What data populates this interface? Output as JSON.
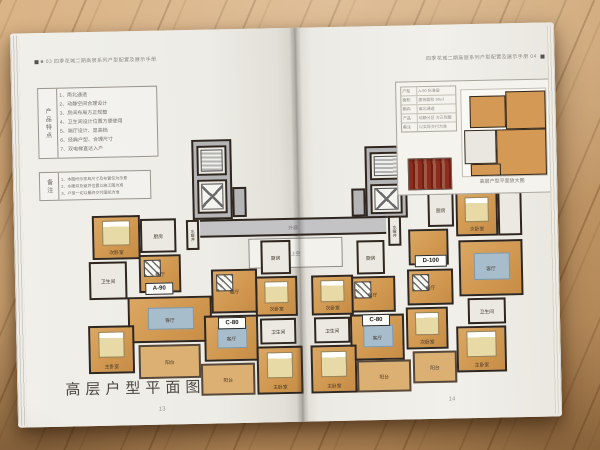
{
  "colors": {
    "wood": "#c49a6a",
    "page": "#efeee8",
    "room_orange": "#d49a55",
    "balcony": "#dcb072",
    "wet_floor": "#ebe9e2",
    "core_grey": "#b5b4b7",
    "wall": "#2f271f",
    "rug_blue": "#a8bdcb",
    "stamp_red": "#8d2b1e"
  },
  "left_page": {
    "header": "■ 03  四季花城二期高层系列户型配置及展示手册",
    "features_table": {
      "header": "产品特点",
      "items": [
        "1、南北通透",
        "2、动静空间合理设计",
        "3、房间布局方正规整",
        "4、卫生间设计位置方便使用",
        "5、端厅设计、显高档",
        "6、经典户型、合理尺寸",
        "7、双电梯直达入户"
      ]
    },
    "notes_table": {
      "header": "备注",
      "items": [
        "1、本图所示家具尺寸及布置仅为示意",
        "2、水暖井及管井位置以施工图为准",
        "3、户型一切以最终交付图纸为准"
      ]
    },
    "caption": "高层户型平面图",
    "page_number": "13"
  },
  "right_page": {
    "header": "四季花城二期高层系列户型配置及展示手册  04 ",
    "inset": {
      "rows": [
        [
          "户型",
          "A-90 标准层"
        ],
        [
          "面积",
          "建筑面积 90㎡"
        ],
        [
          "朝向",
          "南北通透"
        ],
        [
          "产品",
          "动静分区 方正规整"
        ],
        [
          "备注",
          "以实际交付为准"
        ]
      ],
      "caption": "高层户型平面放大图"
    },
    "page_number": "14"
  },
  "floor_plan": {
    "unit_tags": [
      "A-90",
      "C-80",
      "C-80",
      "D-100"
    ],
    "rooms": [
      {
        "name": "core-tower-left",
        "label": "",
        "x": 179,
        "y": 110,
        "w": 40,
        "h": 80,
        "kind": "grey"
      },
      {
        "name": "stair-left",
        "label": "",
        "x": 184,
        "y": 116,
        "w": 30,
        "h": 30,
        "kind": "wet",
        "furn": "stair"
      },
      {
        "name": "elevator-left",
        "label": "",
        "x": 184,
        "y": 150,
        "w": 30,
        "h": 34,
        "kind": "wet",
        "furn": "elev"
      },
      {
        "name": "shaft-left",
        "label": "",
        "x": 219,
        "y": 158,
        "w": 14,
        "h": 30,
        "kind": "grey"
      },
      {
        "name": "core-tower-right",
        "label": "",
        "x": 352,
        "y": 120,
        "w": 42,
        "h": 72,
        "kind": "grey"
      },
      {
        "name": "stair-right",
        "label": "",
        "x": 357,
        "y": 126,
        "w": 32,
        "h": 28,
        "kind": "wet",
        "furn": "stair"
      },
      {
        "name": "elevator-right",
        "label": "",
        "x": 357,
        "y": 158,
        "w": 32,
        "h": 30,
        "kind": "wet",
        "furn": "elev"
      },
      {
        "name": "shaft-right",
        "label": "",
        "x": 338,
        "y": 162,
        "w": 14,
        "h": 28,
        "kind": "grey"
      },
      {
        "name": "corridor",
        "label": "外廊",
        "x": 186,
        "y": 190,
        "w": 186,
        "h": 18,
        "kind": "corridor"
      },
      {
        "name": "void-above",
        "label": "上空",
        "x": 234,
        "y": 210,
        "w": 94,
        "h": 30,
        "kind": "void"
      },
      {
        "name": "pipe-shaft-left",
        "label": "水暖井",
        "x": 172,
        "y": 190,
        "w": 13,
        "h": 30,
        "kind": "wet",
        "vertical": true
      },
      {
        "name": "pipe-shaft-right",
        "label": "水暖井",
        "x": 374,
        "y": 190,
        "w": 13,
        "h": 30,
        "kind": "wet",
        "vertical": true
      },
      {
        "name": "a90-bedroom2",
        "label": "次卧室",
        "x": 78,
        "y": 184,
        "w": 48,
        "h": 44,
        "kind": "room",
        "furn": "bed"
      },
      {
        "name": "a90-bathroom",
        "label": "卫生间",
        "x": 74,
        "y": 230,
        "w": 38,
        "h": 38,
        "kind": "wet"
      },
      {
        "name": "a90-kitchen",
        "label": "厨房",
        "x": 126,
        "y": 188,
        "w": 36,
        "h": 34,
        "kind": "wet"
      },
      {
        "name": "a90-dining",
        "label": "餐厅",
        "x": 124,
        "y": 224,
        "w": 42,
        "h": 38,
        "kind": "room",
        "furn": "hatch"
      },
      {
        "name": "a90-living",
        "label": "客厅",
        "x": 112,
        "y": 266,
        "w": 84,
        "h": 46,
        "kind": "room",
        "furn": "rug"
      },
      {
        "name": "a90-master",
        "label": "主卧室",
        "x": 72,
        "y": 294,
        "w": 46,
        "h": 48,
        "kind": "room",
        "furn": "bed"
      },
      {
        "name": "a90-balcony",
        "label": "阳台",
        "x": 122,
        "y": 314,
        "w": 62,
        "h": 34,
        "kind": "balcony"
      },
      {
        "name": "a90-tag",
        "label": "A-90",
        "x": 130,
        "y": 252,
        "w": 28,
        "h": 12,
        "kind": "tag"
      },
      {
        "name": "c80l-kitchen",
        "label": "厨房",
        "x": 246,
        "y": 212,
        "w": 30,
        "h": 34,
        "kind": "wet"
      },
      {
        "name": "c80l-dining",
        "label": "餐厅",
        "x": 196,
        "y": 240,
        "w": 46,
        "h": 44,
        "kind": "room",
        "furn": "hatch"
      },
      {
        "name": "c80l-bedroom2",
        "label": "次卧室",
        "x": 240,
        "y": 248,
        "w": 42,
        "h": 40,
        "kind": "room",
        "furn": "bed"
      },
      {
        "name": "c80l-bathroom",
        "label": "卫生间",
        "x": 244,
        "y": 290,
        "w": 36,
        "h": 26,
        "kind": "wet"
      },
      {
        "name": "c80l-living",
        "label": "客厅",
        "x": 188,
        "y": 286,
        "w": 54,
        "h": 46,
        "kind": "room",
        "furn": "rug"
      },
      {
        "name": "c80l-master",
        "label": "主卧室",
        "x": 240,
        "y": 318,
        "w": 46,
        "h": 48,
        "kind": "room",
        "furn": "bed"
      },
      {
        "name": "c80l-balcony",
        "label": "阳台",
        "x": 184,
        "y": 334,
        "w": 54,
        "h": 32,
        "kind": "balcony"
      },
      {
        "name": "c80l-tag",
        "label": "C-80",
        "x": 202,
        "y": 288,
        "w": 28,
        "h": 12,
        "kind": "tag"
      },
      {
        "name": "c80r-kitchen",
        "label": "厨房",
        "x": 342,
        "y": 214,
        "w": 28,
        "h": 34,
        "kind": "wet"
      },
      {
        "name": "c80r-dining",
        "label": "餐厅",
        "x": 334,
        "y": 250,
        "w": 46,
        "h": 36,
        "kind": "room",
        "furn": "hatch"
      },
      {
        "name": "c80r-bedroom2",
        "label": "次卧室",
        "x": 296,
        "y": 248,
        "w": 42,
        "h": 40,
        "kind": "room",
        "furn": "bed"
      },
      {
        "name": "c80r-bathroom",
        "label": "卫生间",
        "x": 298,
        "y": 290,
        "w": 36,
        "h": 26,
        "kind": "wet"
      },
      {
        "name": "c80r-living",
        "label": "客厅",
        "x": 334,
        "y": 288,
        "w": 54,
        "h": 46,
        "kind": "room",
        "furn": "rug"
      },
      {
        "name": "c80r-master",
        "label": "主卧室",
        "x": 294,
        "y": 318,
        "w": 46,
        "h": 48,
        "kind": "room",
        "furn": "bed"
      },
      {
        "name": "c80r-balcony",
        "label": "阳台",
        "x": 340,
        "y": 334,
        "w": 54,
        "h": 32,
        "kind": "balcony"
      },
      {
        "name": "c80r-tag",
        "label": "C-80",
        "x": 346,
        "y": 288,
        "w": 28,
        "h": 12,
        "kind": "tag"
      },
      {
        "name": "d100-hall",
        "label": "",
        "x": 394,
        "y": 204,
        "w": 40,
        "h": 36,
        "kind": "room"
      },
      {
        "name": "d100-kitchen",
        "label": "厨房",
        "x": 414,
        "y": 168,
        "w": 26,
        "h": 34,
        "kind": "wet"
      },
      {
        "name": "d100-bedroom2a",
        "label": "次卧室",
        "x": 442,
        "y": 168,
        "w": 42,
        "h": 44,
        "kind": "room",
        "furn": "bed"
      },
      {
        "name": "d100-utility",
        "label": "",
        "x": 484,
        "y": 168,
        "w": 24,
        "h": 44,
        "kind": "wet"
      },
      {
        "name": "d100-living",
        "label": "客厅",
        "x": 444,
        "y": 216,
        "w": 64,
        "h": 56,
        "kind": "room",
        "furn": "rug"
      },
      {
        "name": "d100-dining",
        "label": "餐厅",
        "x": 392,
        "y": 244,
        "w": 46,
        "h": 36,
        "kind": "room",
        "furn": "hatch"
      },
      {
        "name": "d100-bedroom2b",
        "label": "次卧室",
        "x": 390,
        "y": 282,
        "w": 42,
        "h": 42,
        "kind": "room",
        "furn": "bed"
      },
      {
        "name": "d100-bathroom",
        "label": "卫生间",
        "x": 452,
        "y": 274,
        "w": 38,
        "h": 26,
        "kind": "wet"
      },
      {
        "name": "d100-master",
        "label": "主卧室",
        "x": 440,
        "y": 302,
        "w": 50,
        "h": 46,
        "kind": "room",
        "furn": "bed"
      },
      {
        "name": "d100-balcony",
        "label": "阳台",
        "x": 396,
        "y": 326,
        "w": 44,
        "h": 32,
        "kind": "balcony"
      },
      {
        "name": "d100-tag",
        "label": "D-100",
        "x": 400,
        "y": 230,
        "w": 32,
        "h": 12,
        "kind": "tag"
      }
    ]
  }
}
